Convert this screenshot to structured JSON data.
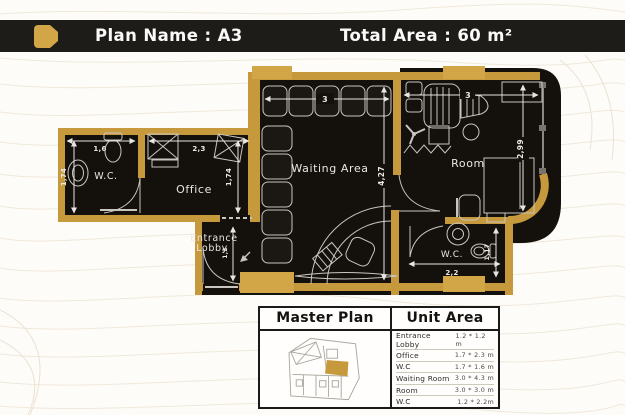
{
  "header": {
    "plan_name_label": "Plan Name : A3",
    "total_area_label": "Total Area : 60 m²"
  },
  "plan": {
    "labels": {
      "wc_left": "W.C.",
      "office": "Office",
      "entrance_l1": "Entrance",
      "entrance_l2": "Lobby",
      "waiting": "Waiting Area",
      "room": "Room",
      "wc_bottom": "W.C."
    },
    "dims": {
      "wc_w": "1,6",
      "wc_h": "1,74",
      "office_w": "2,3",
      "office_h": "1,74",
      "waiting_w": "3",
      "waiting_h": "4,27",
      "room_w": "3",
      "room_h": "2,99",
      "lobby_h": "1,2",
      "wc2_w": "2,2",
      "wc2_h": "1,17"
    }
  },
  "table": {
    "master_plan_header": "Master Plan",
    "unit_area_header": "Unit Area",
    "rows": [
      {
        "label": "Entrance Lobby",
        "value": "1.2 * 1.2 m"
      },
      {
        "label": "Office",
        "value": "1.7 * 2.3 m"
      },
      {
        "label": "W.C",
        "value": "1.7 * 1.6 m"
      },
      {
        "label": "Waiting  Room",
        "value": "3.0 * 4.3 m"
      },
      {
        "label": "Room",
        "value": "3.0 * 3.0 m"
      },
      {
        "label": "W.C",
        "value": "1.2 * 2.2m"
      }
    ]
  },
  "colors": {
    "wall_gold": "#c6993c",
    "tab_gold": "#d2a647",
    "plan_black": "#14100c",
    "header_bg": "#1e1c19",
    "contour_line": "#f0e8db"
  }
}
